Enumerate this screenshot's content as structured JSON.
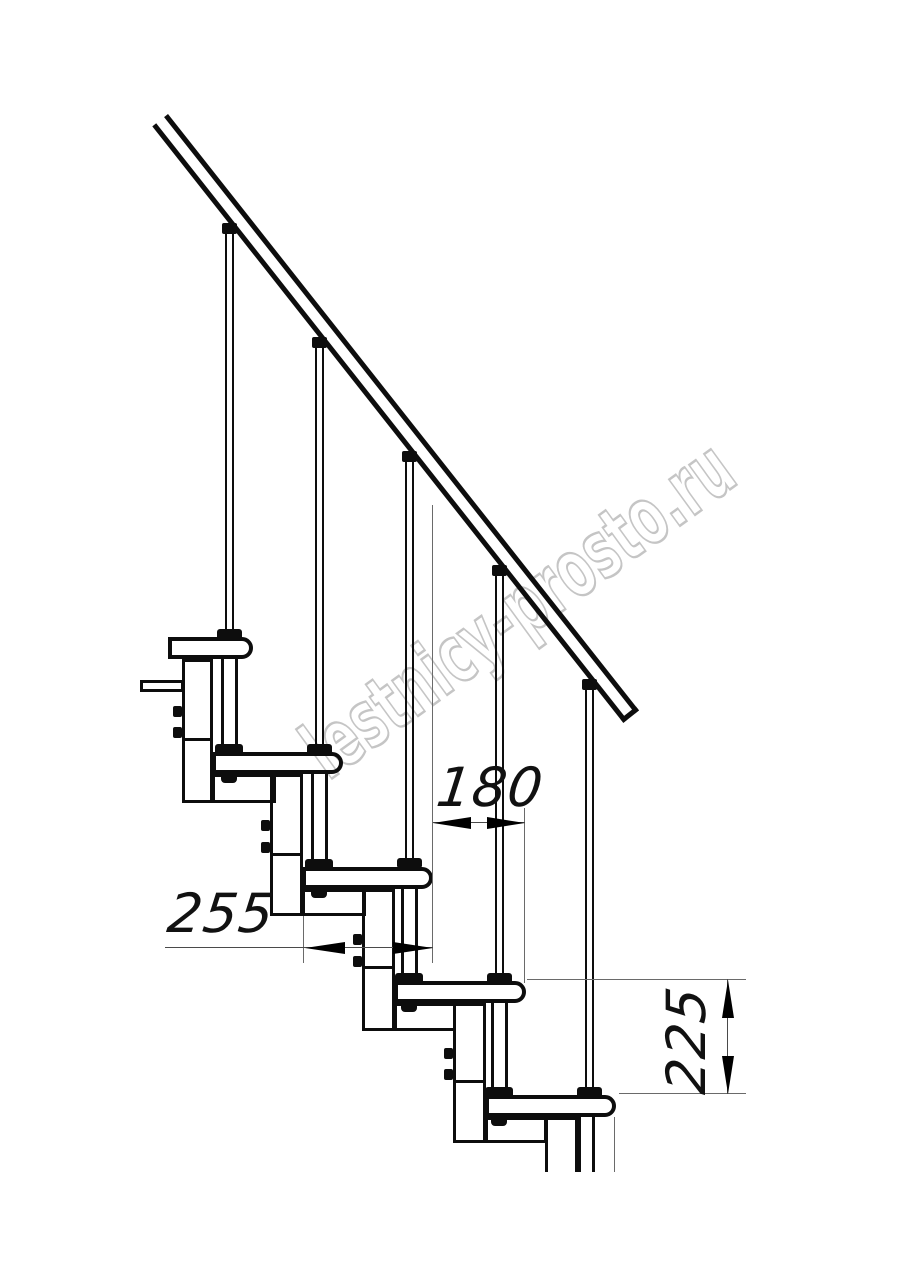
{
  "drawing": {
    "watermark": "lestnicy-prosto.ru",
    "dimensions": {
      "tread_length": "255",
      "step_run": "180",
      "step_rise": "225"
    }
  }
}
